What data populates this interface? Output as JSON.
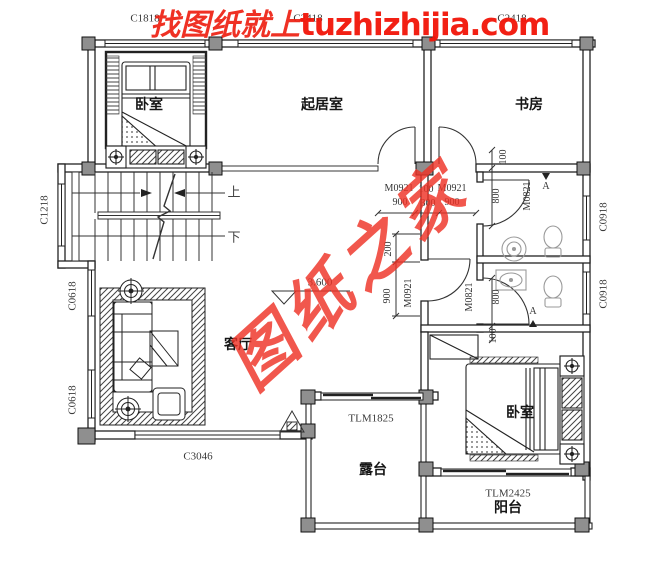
{
  "watermark": {
    "tagline": "找图纸就上",
    "domain": "tuzhizhijia.com",
    "diagonal": "图纸之家",
    "red": "#ee2012"
  },
  "rooms": {
    "bedroom_top": "卧室",
    "family_room": "起居室",
    "study": "书房",
    "living_room": "客厅",
    "bedroom_bottom": "卧室",
    "terrace": "露台",
    "balcony": "阳台"
  },
  "stairs": {
    "up": "上",
    "down": "下"
  },
  "level": {
    "value": "3.600"
  },
  "windows": {
    "c1818": "C1818",
    "c2418_mid": "C2418",
    "c2418_right": "C2418",
    "c1218": "C1218",
    "c0618_upper": "C0618",
    "c0618_lower": "C0618",
    "c0918_upper": "C0918",
    "c0918_lower": "C0918",
    "c3046": "C3046"
  },
  "doors": {
    "m0921_left": "M0921",
    "m0921_right": "M0921",
    "m0921_hall": "M0921",
    "m0821_upper": "M0821",
    "m0821_lower": "M0821",
    "tlm1825": "TLM1825",
    "tlm2425": "TLM2425"
  },
  "dims": {
    "d900_left": "900",
    "d900_right": "900",
    "d900_hall": "900",
    "d100_mid": "100",
    "d300_mid": "300",
    "d100_bath_top": "100",
    "d100_bedroom": "100",
    "d800_upper": "800",
    "d800_lower": "800",
    "d200": "200"
  },
  "section_marks": {
    "a_upper": "A",
    "a_lower": "A"
  },
  "colors": {
    "wall": "#222222",
    "column": "#8f8f8f",
    "fixture": "#9a9a9a",
    "red": "#ee2012"
  }
}
